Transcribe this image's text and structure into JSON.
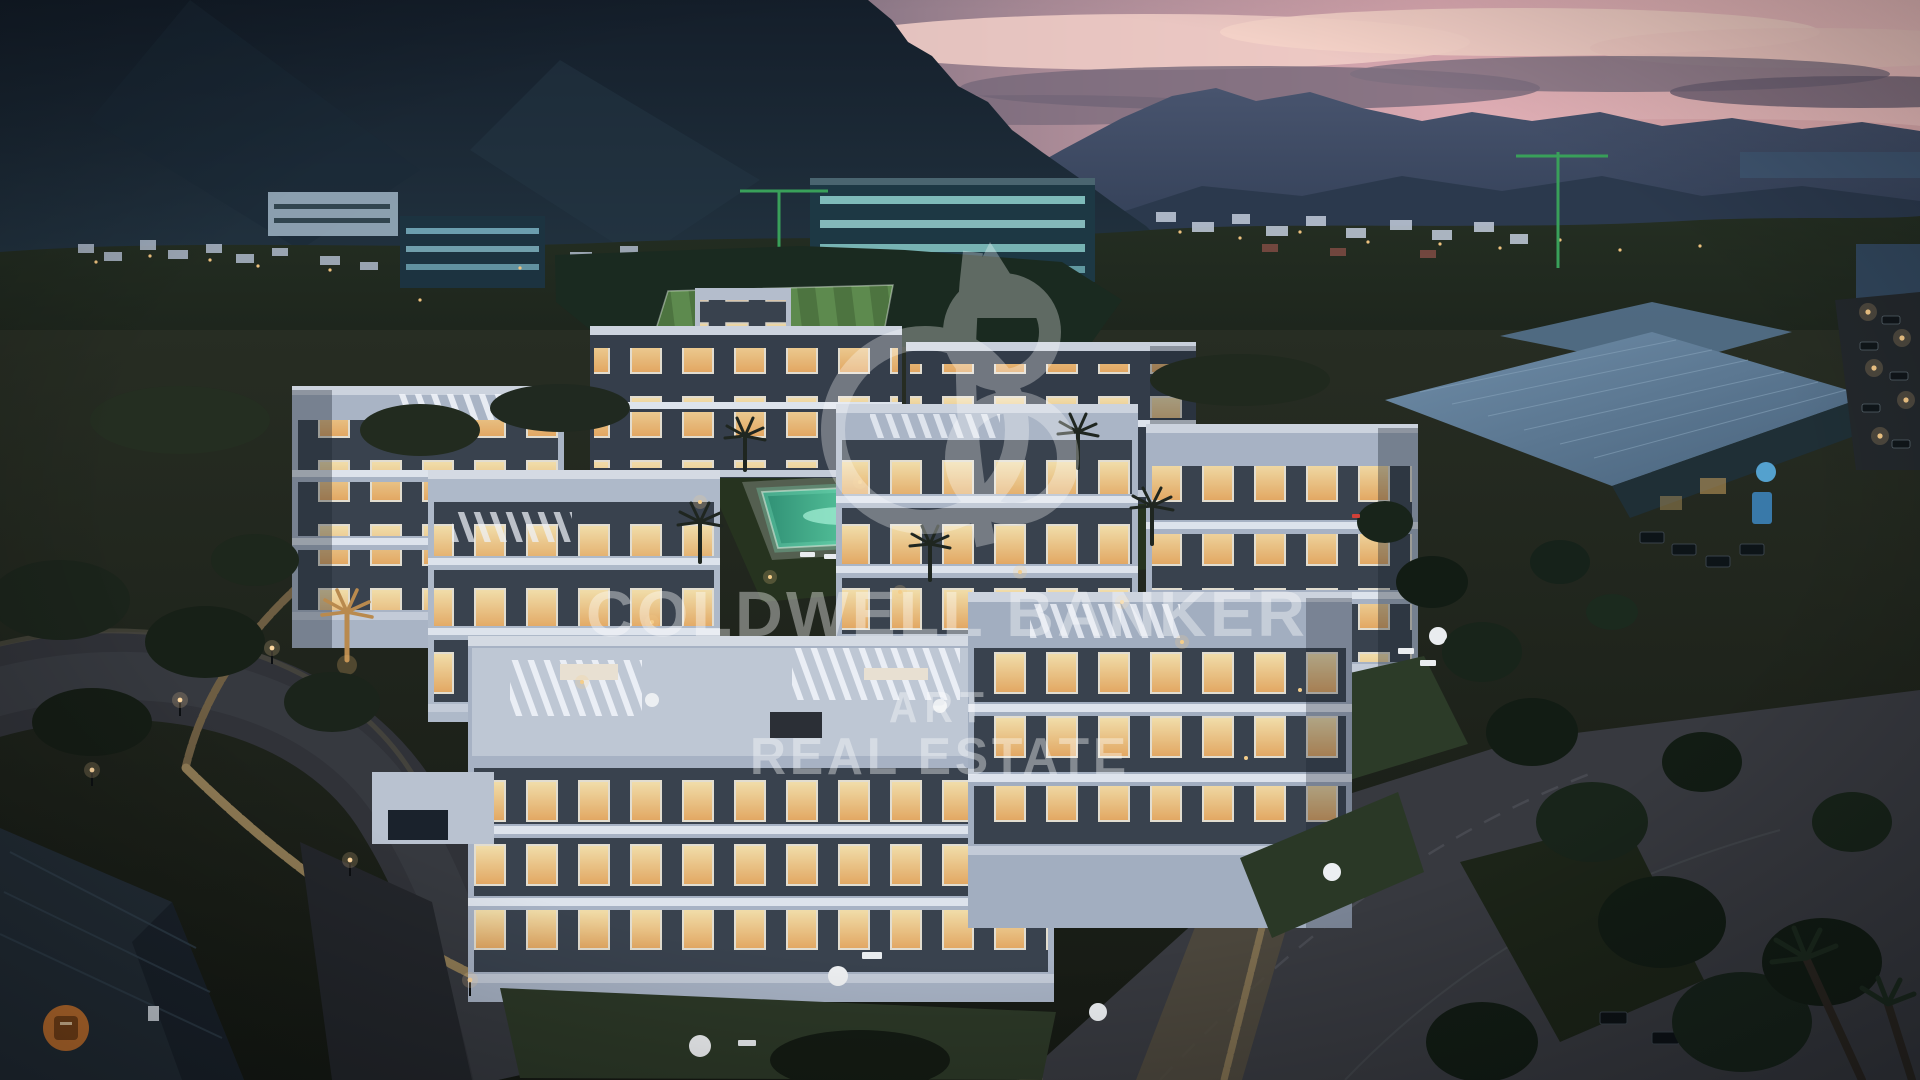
{
  "image": {
    "type": "property-aerial-render",
    "description": "Aerial dusk render of a white modern apartment complex with glowing windows, central pool, sports field, mountains and pink sunset sky"
  },
  "watermark": {
    "logo": "coldwell-banker-monogram",
    "line1": "COLDWELL BANKER",
    "line2": "ART",
    "line3": "REAL ESTATE",
    "color": "#ffffff",
    "opacity": "0.36"
  },
  "palette": {
    "sky_pink": "#e8b7bd",
    "cloud_mauve": "#756879",
    "mountain_dark": "#1a2531",
    "ridge_blue": "#3c4a61",
    "hill_olive": "#232c22",
    "building_white": "#c2cad8",
    "window_glow": "#ffd98f",
    "pool_turquoise": "#6fdcb4",
    "pitch_green": "#517c43",
    "lawn_green": "#2c3a27",
    "road_grey": "#35373d",
    "stone_beige": "#8a7858",
    "sign_orange": "#c8742f",
    "dealer_sign_blue": "#57a8d8"
  }
}
